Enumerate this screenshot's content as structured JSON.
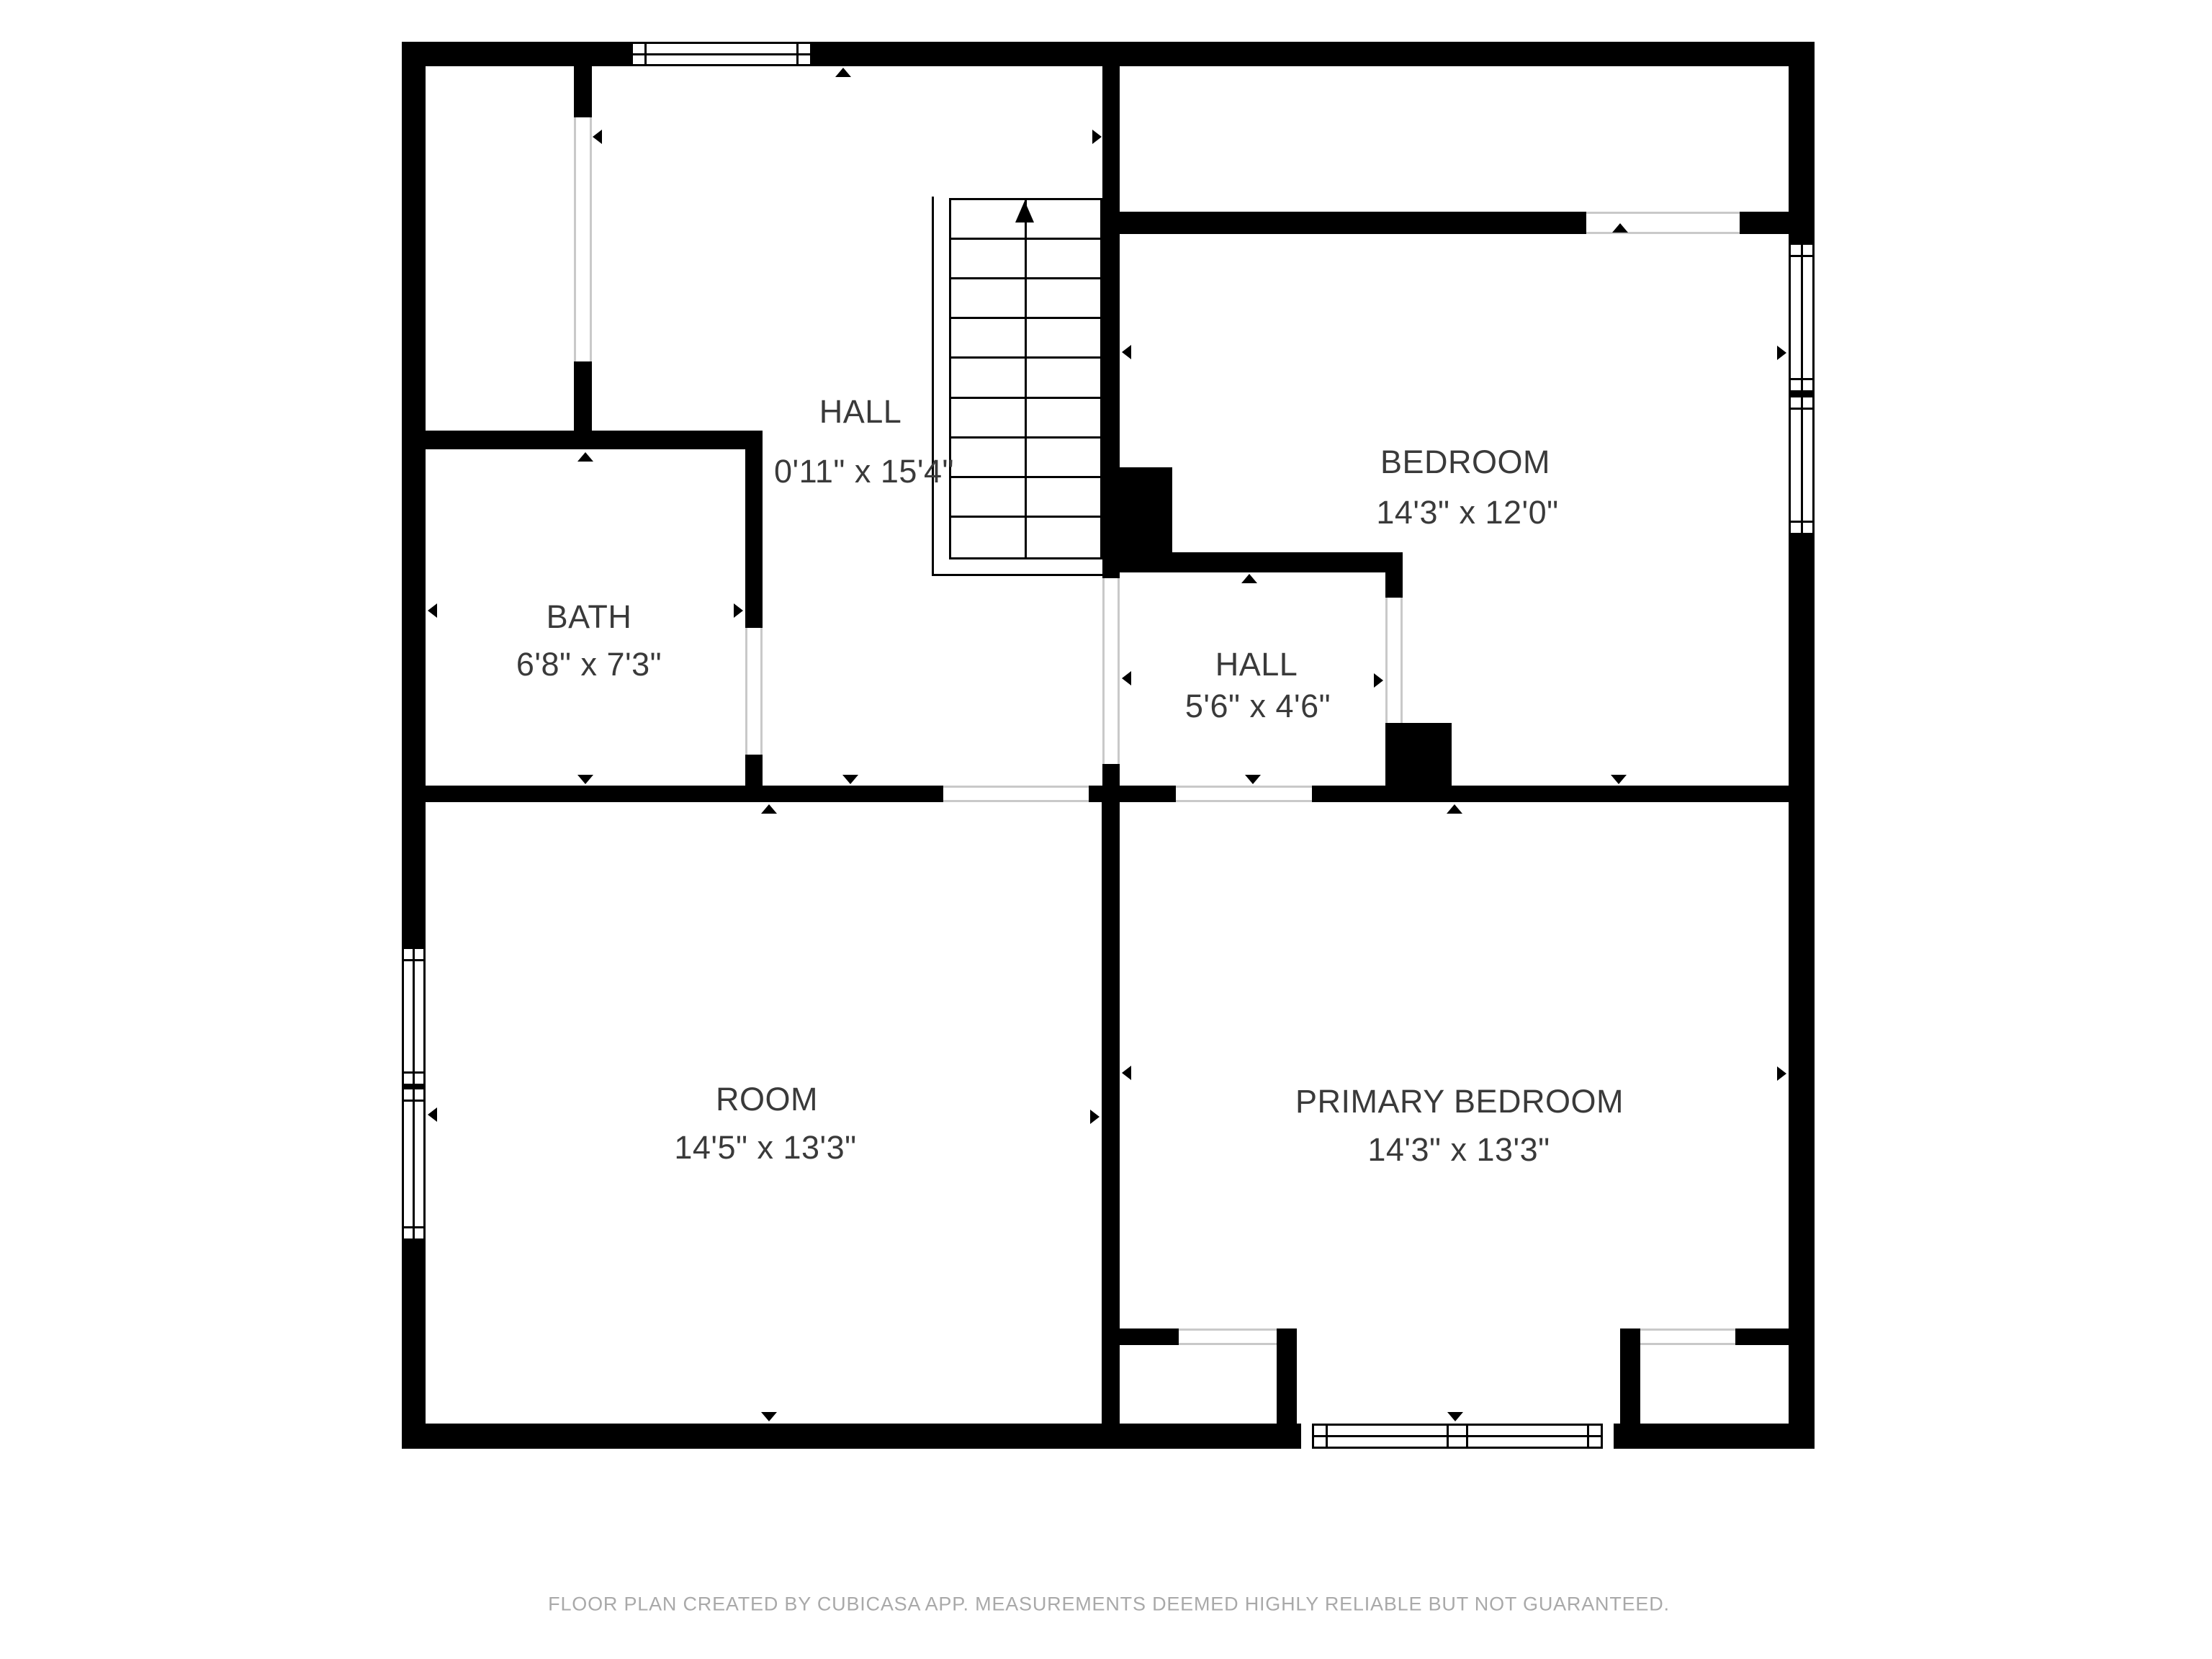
{
  "rooms": {
    "hall_upper": {
      "name": "HALL",
      "dims": "0'11\" x 15'4\""
    },
    "bedroom": {
      "name": "BEDROOM",
      "dims": "14'3\" x 12'0\""
    },
    "bath": {
      "name": "BATH",
      "dims": "6'8\" x 7'3\""
    },
    "hall_lower": {
      "name": "HALL",
      "dims": "5'6\" x 4'6\""
    },
    "room": {
      "name": "ROOM",
      "dims": "14'5\" x 13'3\""
    },
    "primary_bedroom": {
      "name": "PRIMARY BEDROOM",
      "dims": "14'3\" x 13'3\""
    }
  },
  "caption": "FLOOR PLAN CREATED BY CUBICASA APP. MEASUREMENTS DEEMED HIGHLY RELIABLE BUT NOT GUARANTEED.",
  "colors": {
    "wall": "#000000",
    "label_text": "#3a3a3a",
    "caption_text": "#a9a9a9",
    "door_gap_line": "#c9c9c9",
    "background": "#ffffff"
  }
}
